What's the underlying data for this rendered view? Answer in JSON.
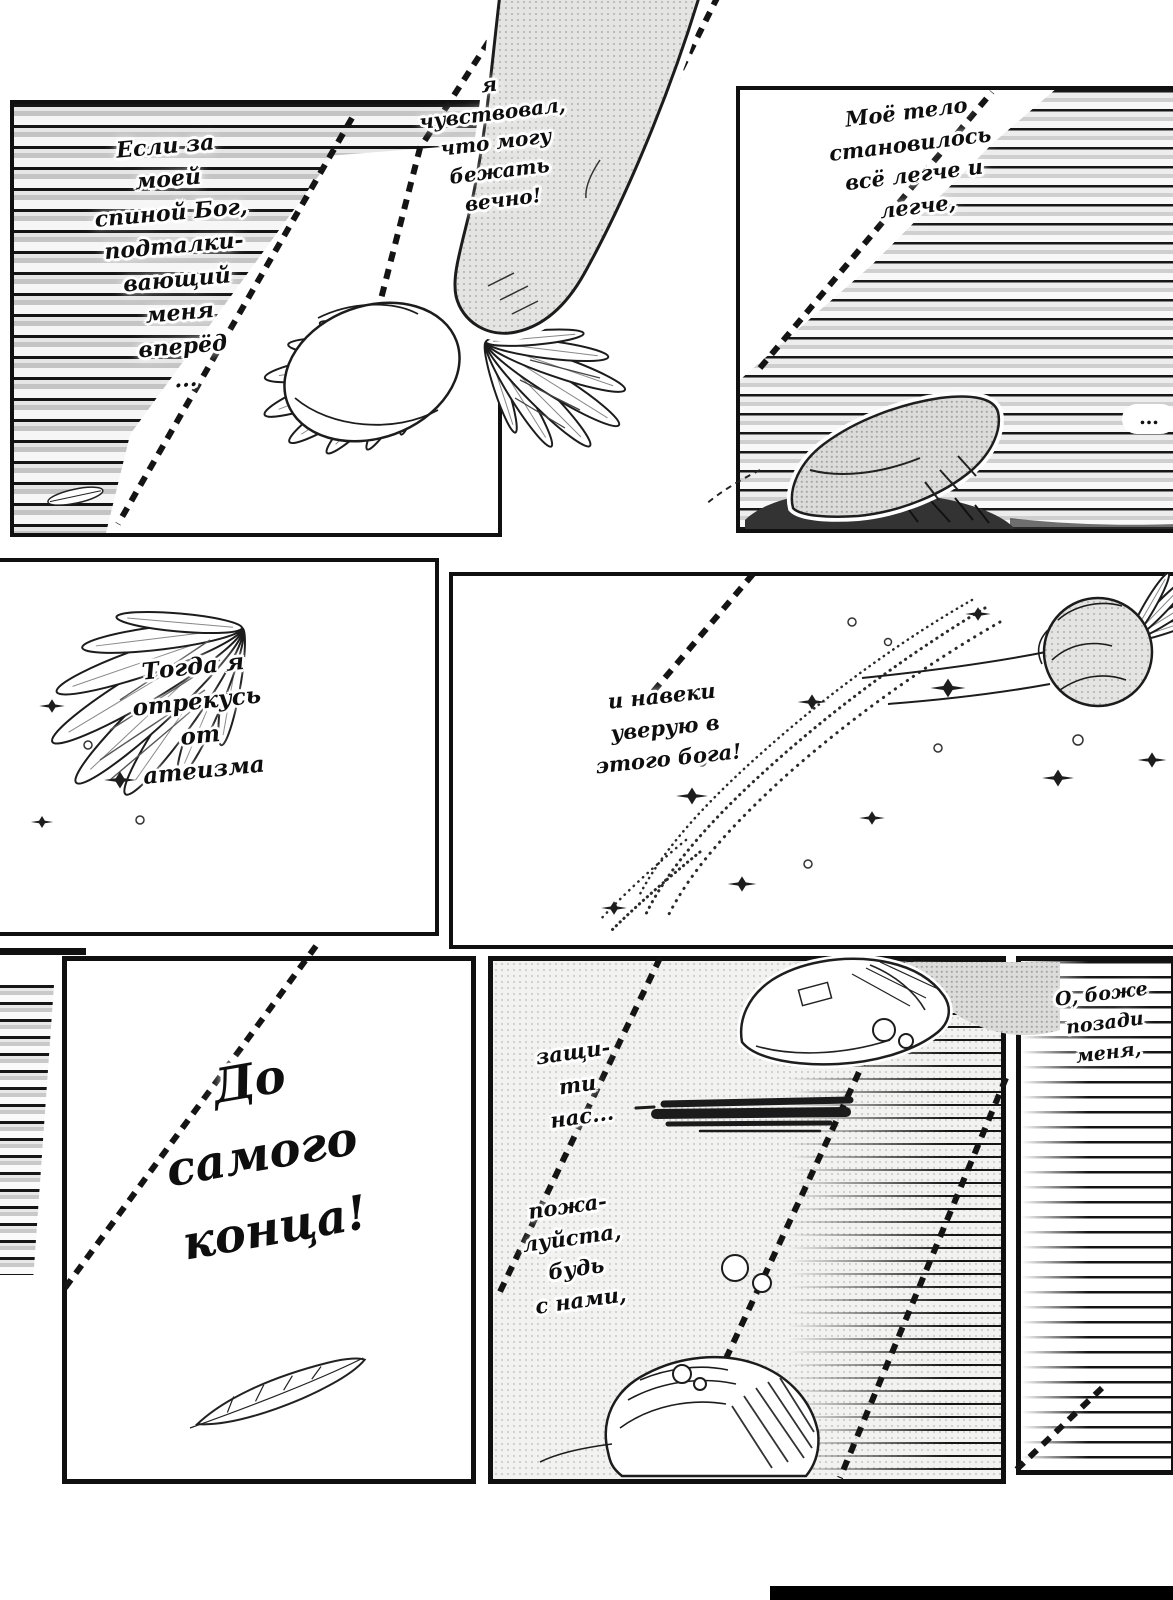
{
  "comic": {
    "balloons": {
      "b1": "Если за\nмоей\nспиной Бог,\nподталки-\nвающий\nменя\nвперёд\n...",
      "b2": "я\nчувствовал,\nчто могу\nбежать\nвечно!",
      "b3": "Моё тело\nстановилось\nвсё легче и\nлегче,",
      "b4": "Тогда я\nотрекусь\nот\nатеизма",
      "b5": "и навеки\nуверую в\nэтого бога!",
      "b6": "До\nсамого\nконца!",
      "b7": "защи-\nти\nнас...",
      "b8": "пожа-\nлуйста,\nбудь\nс нами,",
      "b9": "О, боже\nпозади\nменя,",
      "ellipsis": "…"
    },
    "colors": {
      "ink": "#111111",
      "paper": "#ffffff",
      "tone_grey": "#d9d9d9"
    }
  }
}
